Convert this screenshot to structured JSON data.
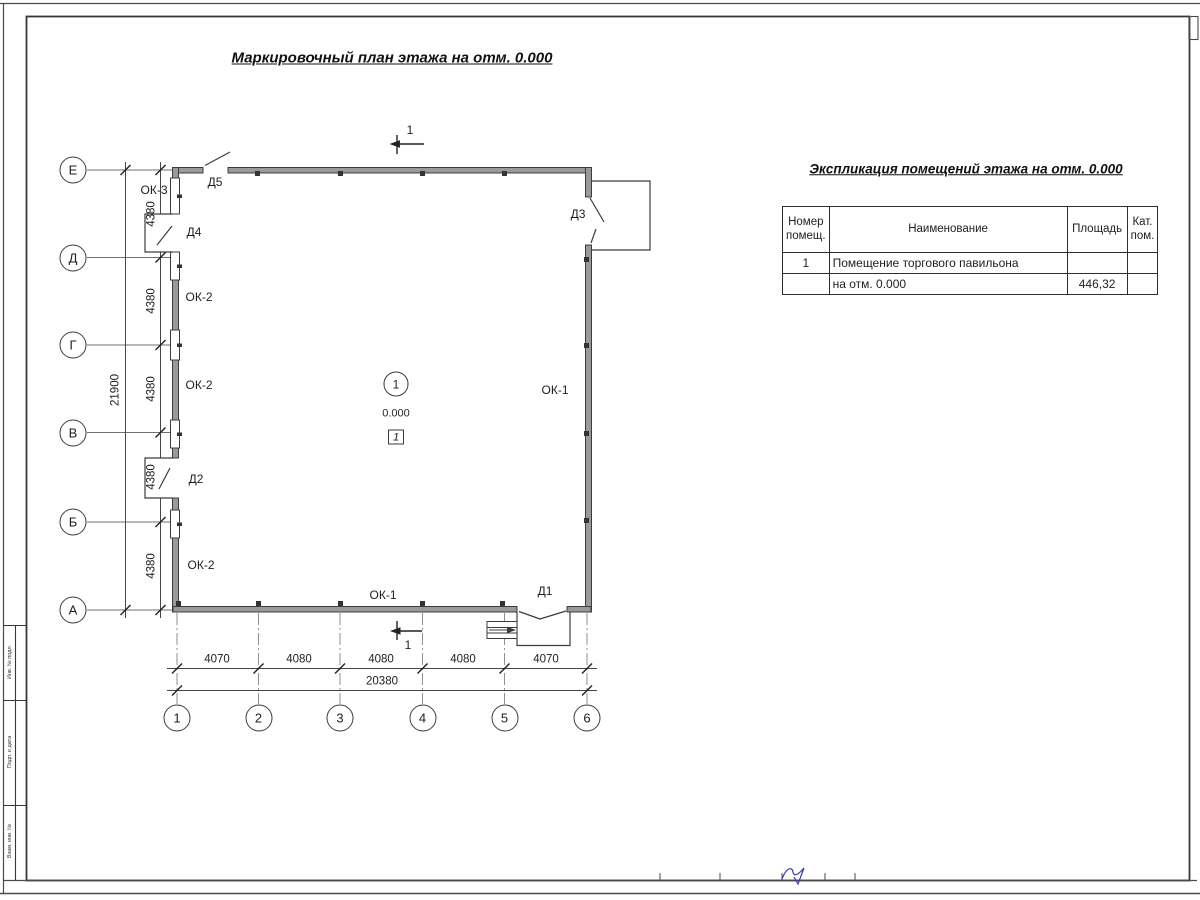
{
  "titles": {
    "plan": "Маркировочный план этажа на отм. 0.000",
    "explication": "Экспликация помещений этажа на отм. 0.000"
  },
  "axes": {
    "left": [
      "Е",
      "Д",
      "Г",
      "В",
      "Б",
      "А"
    ],
    "bottom": [
      "1",
      "2",
      "3",
      "4",
      "5",
      "6"
    ]
  },
  "dims": {
    "left_segment": "4380",
    "left_total": "21900",
    "bottom_segments": [
      "4070",
      "4080",
      "4080",
      "4080",
      "4070"
    ],
    "bottom_total": "20380"
  },
  "marks": {
    "ok1": "ОК-1",
    "ok2": "ОК-2",
    "ok3": "ОК-3",
    "d1": "Д1",
    "d2": "Д2",
    "d3": "Д3",
    "d4": "Д4",
    "d5": "Д5",
    "room_number": "1",
    "elevation": "0.000",
    "floor_type": "1",
    "section": "1"
  },
  "table": {
    "headers": {
      "num": "Номер помещ.",
      "name": "Наименование",
      "area": "Площадь",
      "cat": "Кат. пом."
    },
    "rows": [
      {
        "num": "1",
        "name": "Помещение торгового павильона",
        "area": "",
        "cat": ""
      },
      {
        "num": "",
        "name": "на отм. 0.000",
        "area": "446,32",
        "cat": ""
      }
    ]
  },
  "stamp": {
    "side_cells": [
      "Инв. № подл.",
      "Подп. и дата",
      "Взам. инв. №"
    ]
  },
  "colors": {
    "wall_fill": "#9a9a9a",
    "line": "#3c3c3c",
    "axis_dash": "#8f8f8f",
    "signature": "#3a3aad"
  }
}
